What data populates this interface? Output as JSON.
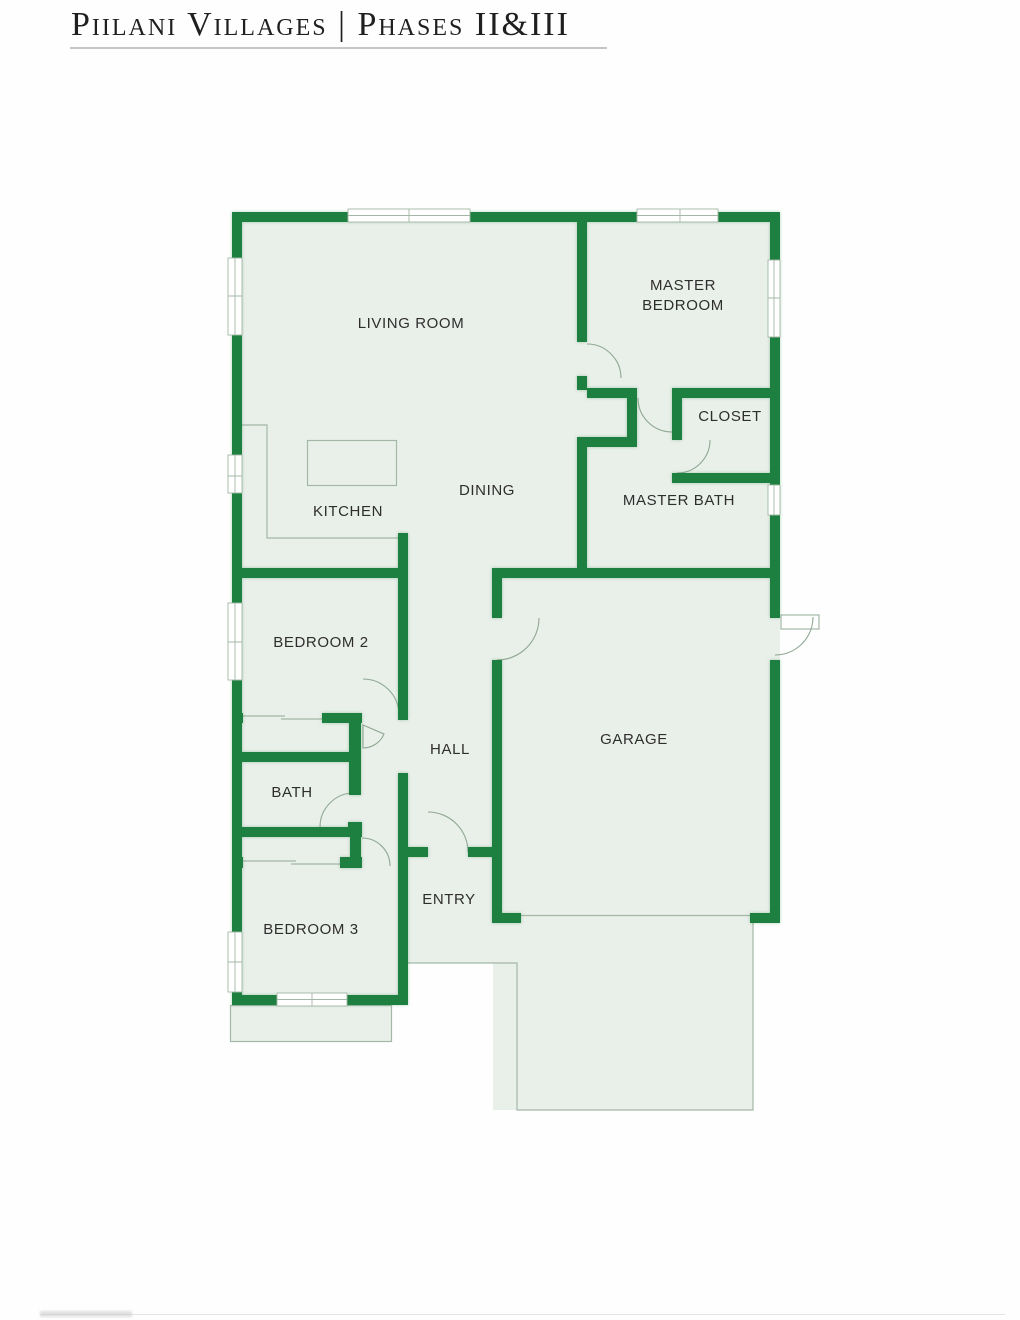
{
  "title": {
    "text": "Piilani Villages | Phases II&III"
  },
  "palette": {
    "wall_green": "#1e8040",
    "floor_green": "#e9efe9",
    "thin_line": "#a3b8a6",
    "arc_line": "#8fa893",
    "label_text": "#2e2e2e",
    "title_text": "#1f1f1f",
    "underline_gray": "#c6c6c6",
    "background": "#fefefe"
  },
  "rooms": {
    "living_room": {
      "label": "LIVING ROOM"
    },
    "master_bedroom": {
      "line1": "MASTER",
      "line2": "BEDROOM"
    },
    "closet": {
      "label": "CLOSET"
    },
    "dining": {
      "label": "DINING"
    },
    "master_bath": {
      "label": "MASTER BATH"
    },
    "kitchen": {
      "label": "KITCHEN"
    },
    "bedroom2": {
      "label": "BEDROOM 2"
    },
    "hall": {
      "label": "HALL"
    },
    "garage": {
      "label": "GARAGE"
    },
    "bath": {
      "label": "BATH"
    },
    "entry": {
      "label": "ENTRY"
    },
    "bedroom3": {
      "label": "BEDROOM 3"
    }
  }
}
